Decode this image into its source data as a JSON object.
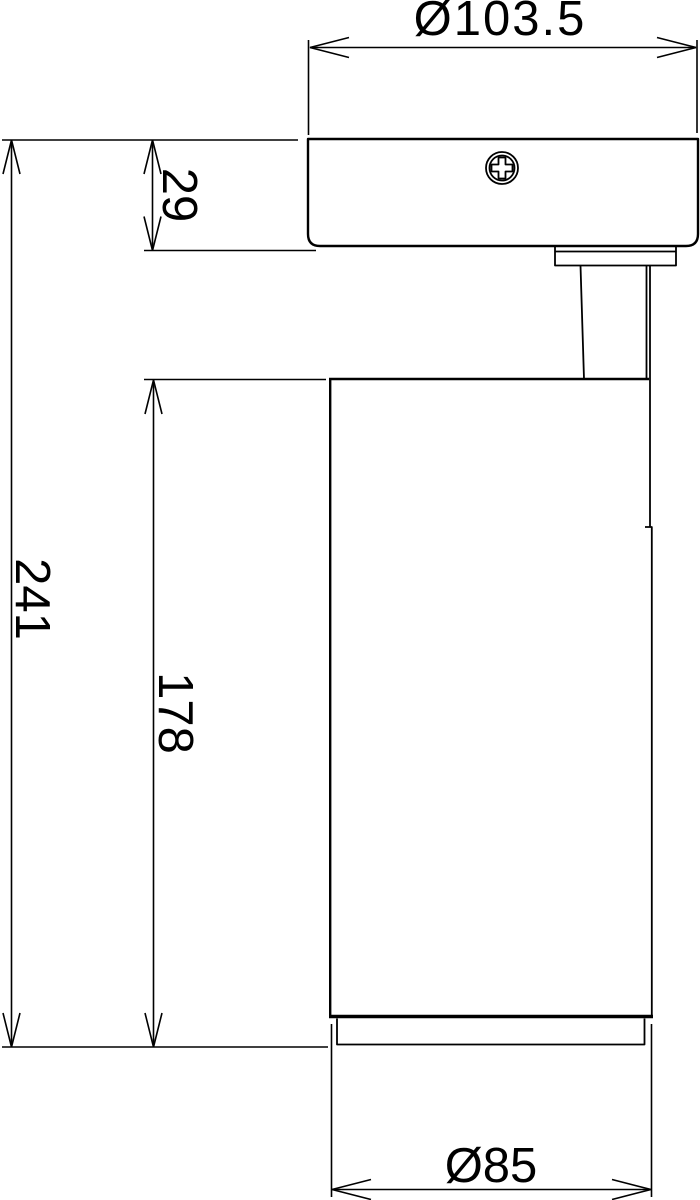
{
  "colors": {
    "line": "#000000",
    "background": "#ffffff"
  },
  "drawing": {
    "kind": "dimensioned technical line drawing",
    "view": "surface-mounted spotlight, side elevation"
  },
  "dimensions": {
    "canopy_diameter": {
      "label": "Ø103.5",
      "value": 103.5
    },
    "canopy_height": {
      "label": "29",
      "value": 29
    },
    "overall_height": {
      "label": "241",
      "value": 241
    },
    "body_height": {
      "label": "178",
      "value": 178
    },
    "body_diameter": {
      "label": "Ø85",
      "value": 85
    }
  },
  "icons": {
    "screw_head": "phillips-screw-head"
  }
}
